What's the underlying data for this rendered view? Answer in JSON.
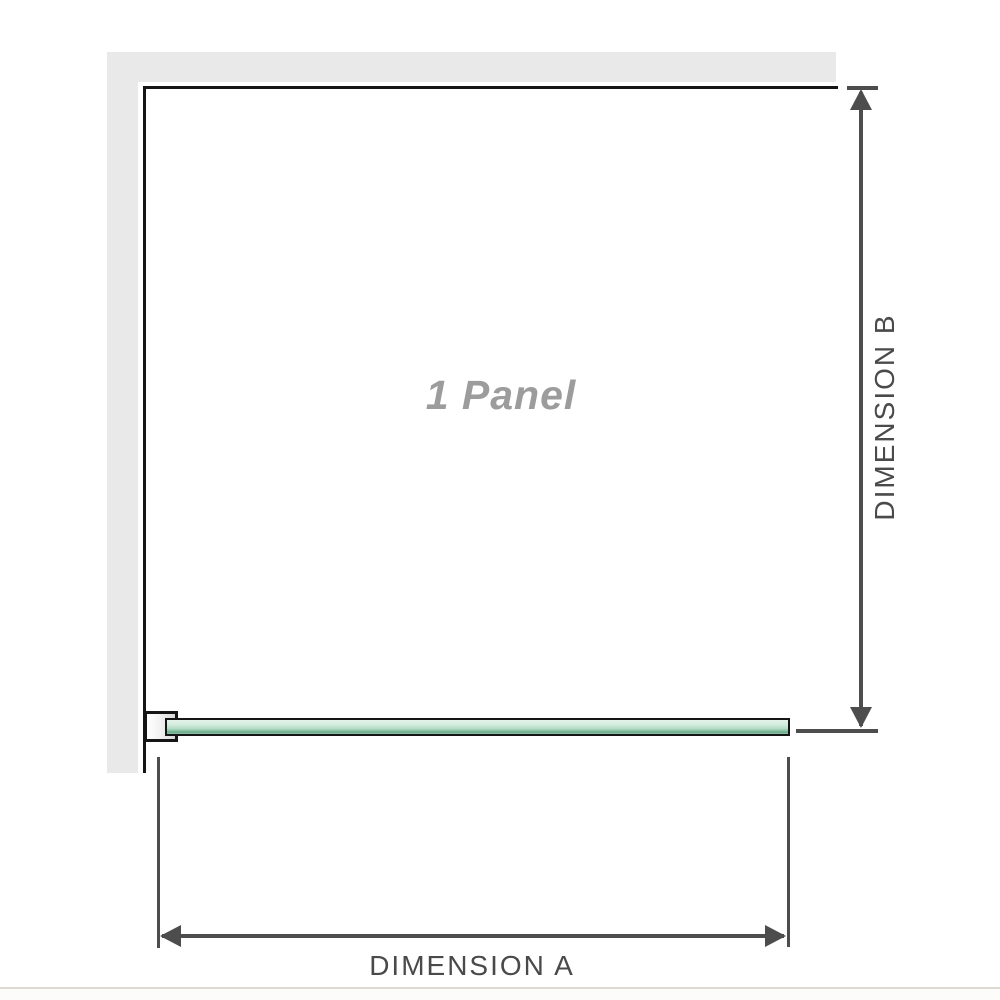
{
  "diagram": {
    "title": "shower-screen-panel-plan-diagram",
    "panel_label": "1 Panel",
    "dimension_a": {
      "label": "DIMENSION A",
      "axis": "horizontal"
    },
    "dimension_b": {
      "label": "DIMENSION B",
      "axis": "vertical"
    },
    "icons": [
      "arrow-up-icon",
      "arrow-down-icon",
      "arrow-left-icon",
      "arrow-right-icon"
    ],
    "colors": {
      "wall_fill": "#e9e9e9",
      "outline_black": "#151515",
      "dimension_gray": "#4d4d4d",
      "label_text_gray": "#4a4a4a",
      "panel_label_gray": "#9c9c9c",
      "glass_green_light": "#e6f4ec",
      "glass_green_dark": "#69aa88",
      "bottom_strip": "#dbd9d1"
    }
  }
}
